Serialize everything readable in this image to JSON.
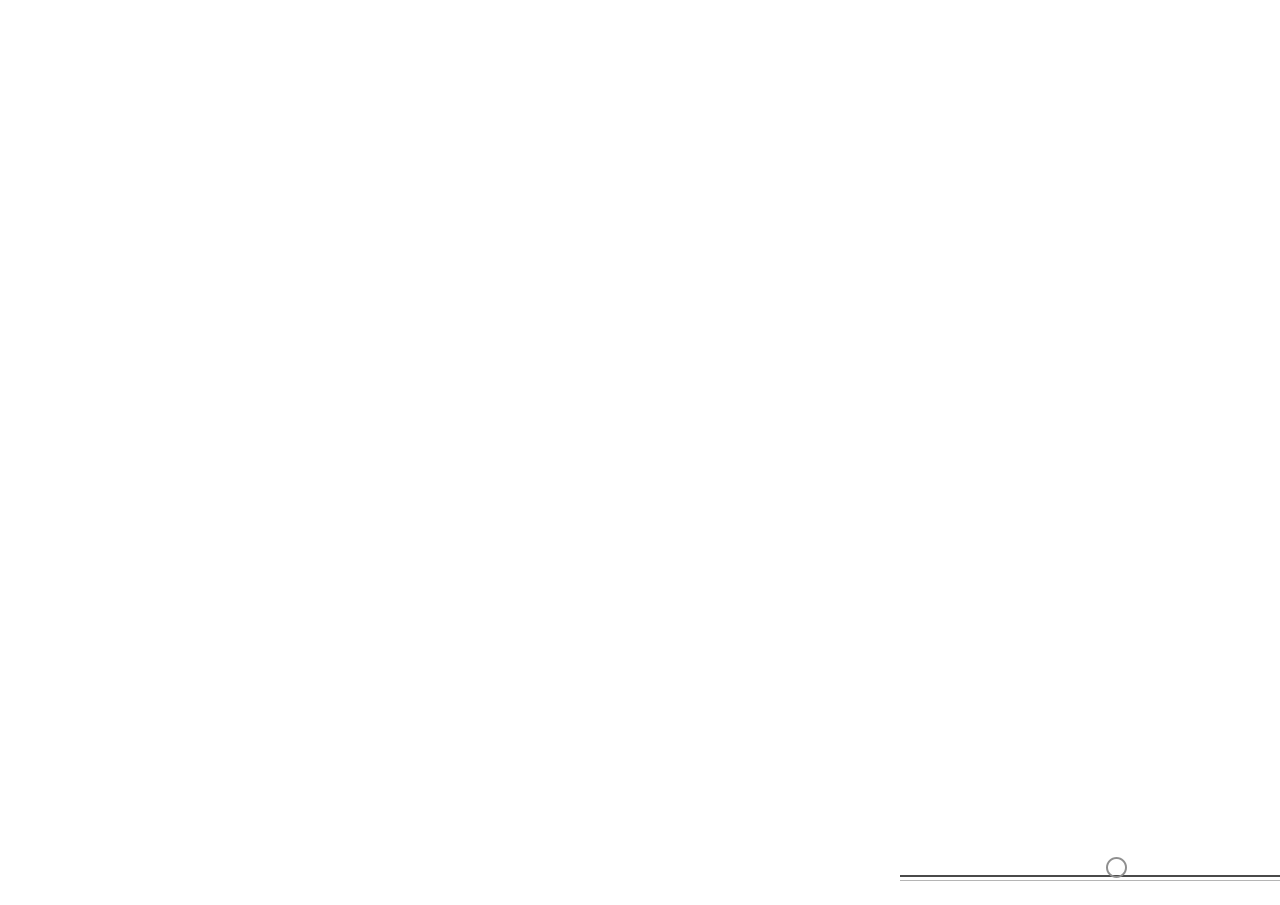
{
  "watermark": "Housley.com",
  "main_road_label": "MAIN ROAD",
  "lake_labels": [
    "LAKE",
    "LAKE",
    "LAKE",
    "LAKE"
  ],
  "compass": {
    "top": "S",
    "bottom": "N",
    "left": "E",
    "right": "W"
  },
  "legend": {
    "title": "L E G E N D :",
    "columns": [
      [
        "1. Access entry road to site",
        "2. Zebra crossing",
        "3. Transformer yard",
        "4. Ramp down to basement",
        "5. Jogging track / Cycling track",
        "6. Toddlers deck at lower level",
        "7. Water body at lower level",
        "8. Water body with infinity edge",
        "9. Water cascading edge"
      ],
      [
        "10. Lounge",
        "11. Pathway connecting to perimeter water body",
        "12. Amphitheater with stepped green",
        "13. Ramp down",
        "14. View gallery",
        "15. Community plaza",
        "16. Barbeque kund",
        "17. Bermed green with large trees",
        "18. Yoga deck in timber"
      ],
      [
        "19. Connecting bridge",
        "20. Ramp connecting to play courts level & toddler\ndeck level",
        "21. Community seating corners in stone laid in\nplanked fashion",
        "22. Chess board plaza",
        "23. Multi-court",
        "24. Stepped seating",
        "25. Play pavilion"
      ],
      [
        "26. Stepped seating",
        "27. Tennis court",
        "28. Cycle stand",
        "29. Dense planting",
        "30. Baseball court",
        "31. Tree house",
        "32. Skating Plaza",
        "33. Locomotive kids play area",
        "34. Play lawn"
      ],
      [
        "35. Pixelated tree plaza",
        "36. Elders gym",
        "37. Pebble reflexology",
        "38. Water reflexology",
        "39. Stage",
        "40. Amphitheater",
        "41. Kids play area with equipment's",
        "42. Toddler pit",
        "43. Cricket practice pitch"
      ],
      [
        "44. Private balcony",
        "45. Butterfly garden",
        "46. Buddha statue",
        "47. Temple bell",
        "48. Seater cubes",
        "49. Hugging pillar",
        "50. Elders gym",
        "51. Satsang deck",
        "52. Flooring in planked fashion"
      ],
      [
        "53. Galleried seating"
      ]
    ]
  },
  "plan_markers": [
    [
      1,
      36,
      478
    ],
    [
      2,
      79,
      481
    ],
    [
      3,
      59,
      449
    ],
    [
      4,
      88,
      390
    ],
    [
      5,
      117,
      420
    ],
    [
      6,
      164,
      444
    ],
    [
      7,
      164,
      472
    ],
    [
      8,
      235,
      463
    ],
    [
      9,
      256,
      486
    ],
    [
      10,
      319,
      463
    ],
    [
      11,
      306,
      432
    ],
    [
      12,
      353,
      450
    ],
    [
      13,
      393,
      483
    ],
    [
      14,
      413,
      457
    ],
    [
      15,
      423,
      439
    ],
    [
      16,
      476,
      482
    ],
    [
      17,
      507,
      478
    ],
    [
      18,
      473,
      438
    ],
    [
      19,
      394,
      402
    ],
    [
      20,
      439,
      392
    ],
    [
      21,
      542,
      388
    ],
    [
      22,
      577,
      373
    ],
    [
      23,
      635,
      432
    ],
    [
      24,
      656,
      376
    ],
    [
      25,
      760,
      382
    ],
    [
      26,
      816,
      375
    ],
    [
      27,
      797,
      420
    ],
    [
      28,
      797,
      477
    ],
    [
      29,
      608,
      430
    ],
    [
      30,
      897,
      429
    ],
    [
      31,
      907,
      367
    ],
    [
      32,
      986,
      406
    ],
    [
      33,
      1056,
      419
    ],
    [
      34,
      1114,
      411
    ],
    [
      35,
      1181,
      384
    ],
    [
      36,
      1154,
      341
    ],
    [
      37,
      1053,
      449
    ],
    [
      38,
      1037,
      466
    ],
    [
      39,
      1094,
      481
    ],
    [
      40,
      1112,
      458
    ],
    [
      41,
      1202,
      321
    ],
    [
      42,
      1177,
      285
    ],
    [
      43,
      1091,
      378
    ],
    [
      44,
      1106,
      358
    ],
    [
      45,
      345,
      389
    ],
    [
      46,
      313,
      391
    ],
    [
      47,
      274,
      389
    ],
    [
      48,
      160,
      391
    ],
    [
      49,
      213,
      391
    ],
    [
      50,
      110,
      313
    ],
    [
      51,
      116,
      250
    ],
    [
      52,
      111,
      218
    ],
    [
      53,
      121,
      202
    ]
  ],
  "title_block": {
    "title": "GROUND FLOOR MASTER PLAN",
    "revision": "V1  R0",
    "studio_name": "g r e y   s c a l e",
    "studio_initial": "G",
    "studio_sub": "D E S I G N   S T U D I O",
    "contact_line1": "Ph : +91 .........",
    "contact_line2": "e-mail : info@greyscale.in",
    "client_label": "CLIENT",
    "client": ": GRC INFRA PVT LTD",
    "project_label": "PROJECT",
    "project": ": GRC SHREE KRISH",
    "date_label": "DATE",
    "date": ": 11.04.2023",
    "scale_label": "SCALE",
    "scale": ": 1 : 250"
  },
  "colors": {
    "lake": "#b7dbda",
    "lake_deep": "#a9d2d1",
    "site_green": "#7ca23f",
    "lawn": "#8cc043",
    "dark_green": "#5f8f34",
    "road": "#6f6f6f",
    "inner_road": "#a2a29a",
    "path_tan": "#e8d4ac",
    "corridor": "#eccfa0",
    "building": "#efe6d2",
    "court_blue": "#3e86a3",
    "court_red": "#9d4a52",
    "pool": "#58a287",
    "sand": "#ecd09e"
  }
}
